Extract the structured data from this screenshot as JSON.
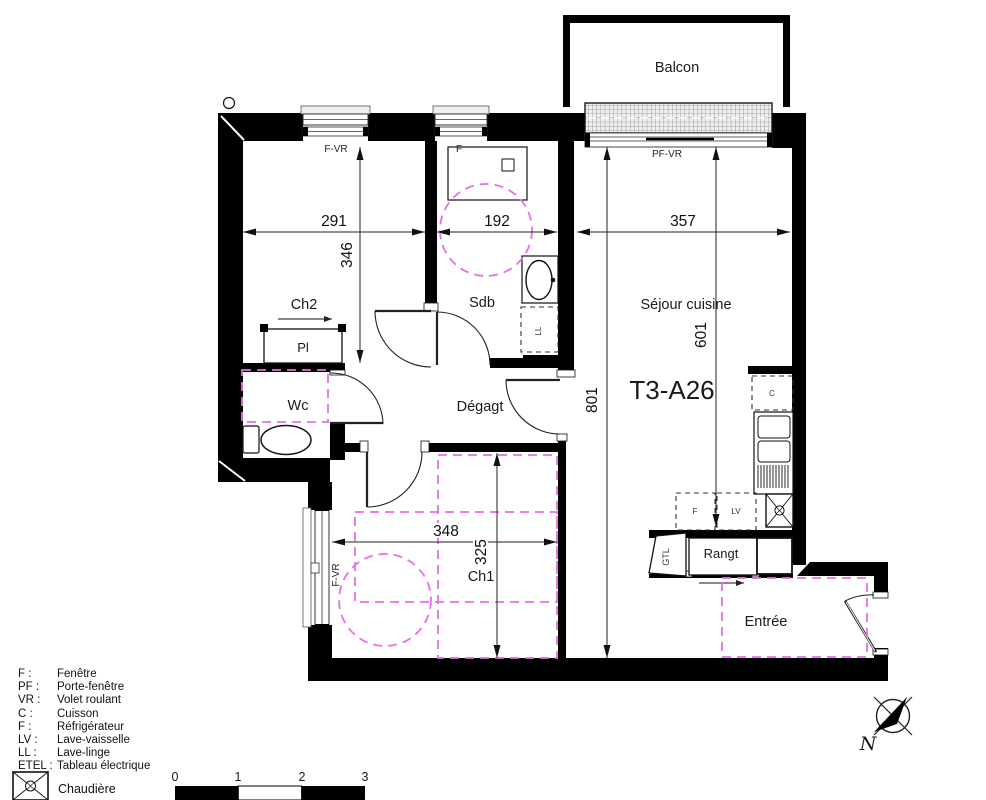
{
  "title": "T3-A26",
  "plan": {
    "rooms": {
      "balcon": "Balcon",
      "ch2": "Ch2",
      "pl": "Pl",
      "wc": "Wc",
      "sdb": "Sdb",
      "degagt": "Dégagt",
      "sejour": "Séjour cuisine",
      "ch1": "Ch1",
      "rangt": "Rangt",
      "entree": "Entrée"
    },
    "openings": {
      "fvr_top": "F-VR",
      "f_top": "F",
      "pfvr": "PF-VR",
      "fvr_ch1": "F-VR"
    },
    "appliances": {
      "c": "C",
      "f": "F",
      "lv": "LV",
      "ll": "LL",
      "gtl": "GTL"
    },
    "dims": {
      "d291": "291",
      "d192": "192",
      "d357": "357",
      "d346": "346",
      "d801": "801",
      "d601": "601",
      "d348": "348",
      "d325": "325"
    }
  },
  "legend": {
    "rows": [
      {
        "abbr": "F :",
        "label": "Fenêtre"
      },
      {
        "abbr": "PF :",
        "label": "Porte-fenêtre"
      },
      {
        "abbr": "VR :",
        "label": "Volet roulant"
      },
      {
        "abbr": "C :",
        "label": "Cuisson"
      },
      {
        "abbr": "F :",
        "label": "Réfrigérateur"
      },
      {
        "abbr": "LV :",
        "label": "Lave-vaisselle"
      },
      {
        "abbr": "LL :",
        "label": "Lave-linge"
      },
      {
        "abbr": "ETEL :",
        "label": "Tableau électrique"
      }
    ],
    "chaudiere": "Chaudière"
  },
  "scalebar": {
    "labels": [
      "0",
      "1",
      "2",
      "3"
    ]
  },
  "compass": {
    "north": "N"
  },
  "colors": {
    "wall": "#000000",
    "zone": "#e66fe6",
    "hatch_bg": "#efefef"
  }
}
